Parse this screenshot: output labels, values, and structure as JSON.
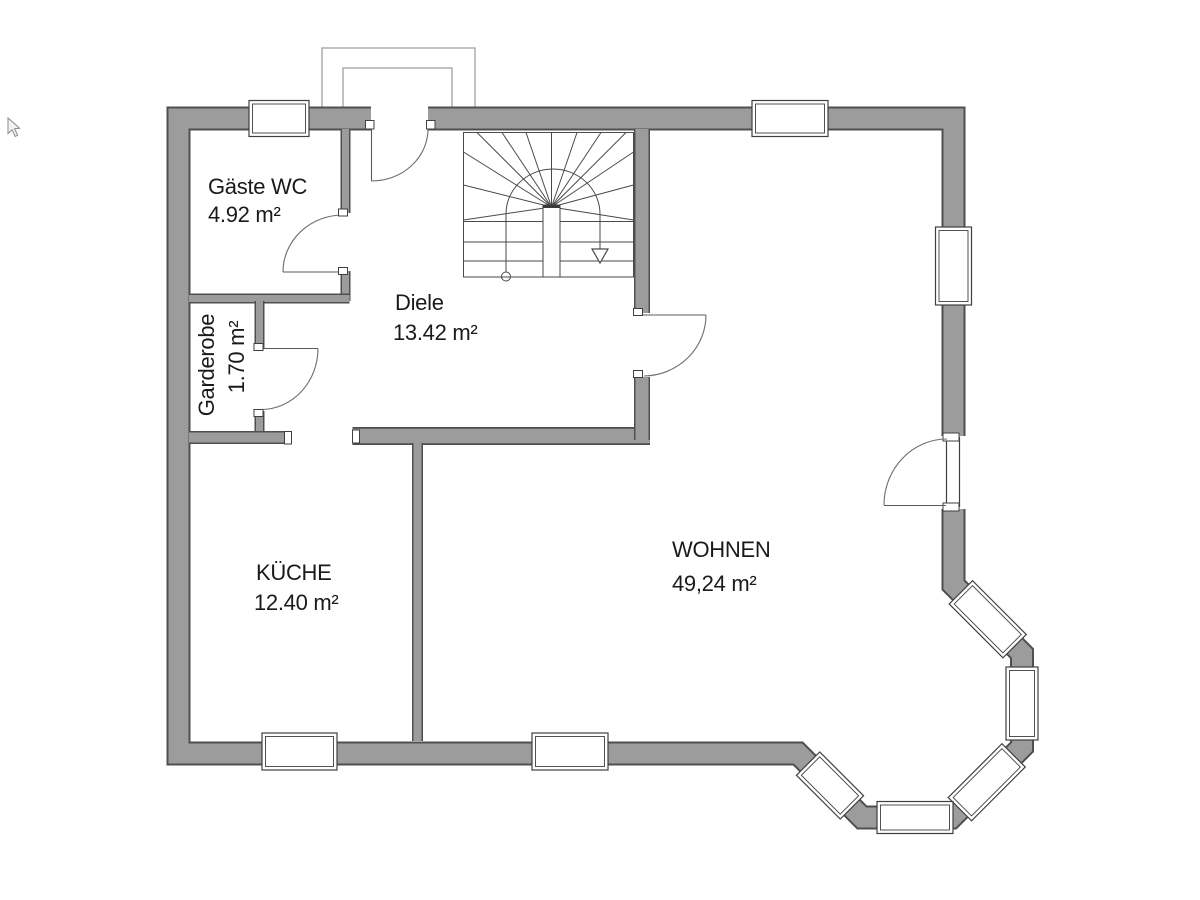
{
  "title": "Erdgeschoss Grundriss (ground floor plan)",
  "rooms": [
    {
      "id": "gaeste-wc",
      "name": "Gäste WC",
      "area": "4.92 m²"
    },
    {
      "id": "garderobe",
      "name": "Garderobe",
      "area": "1.70 m²"
    },
    {
      "id": "diele",
      "name": "Diele",
      "area": "13.42 m²"
    },
    {
      "id": "kueche",
      "name": "KÜCHE",
      "area": "12.40 m²"
    },
    {
      "id": "wohnen",
      "name": "WOHNEN",
      "area": "49,24 m²"
    }
  ],
  "symbols": {
    "stair_walk_arrow_icon": "triangle-down",
    "walk_line_start_icon": "circle",
    "cursor_icon": "mouse-pointer"
  },
  "colors": {
    "background": "#ffffff",
    "wall_fill": "#9c9c9c",
    "wall_outline": "#4f4f4f",
    "thin_line": "#4a4a4a",
    "text": "#1a1a1a"
  }
}
